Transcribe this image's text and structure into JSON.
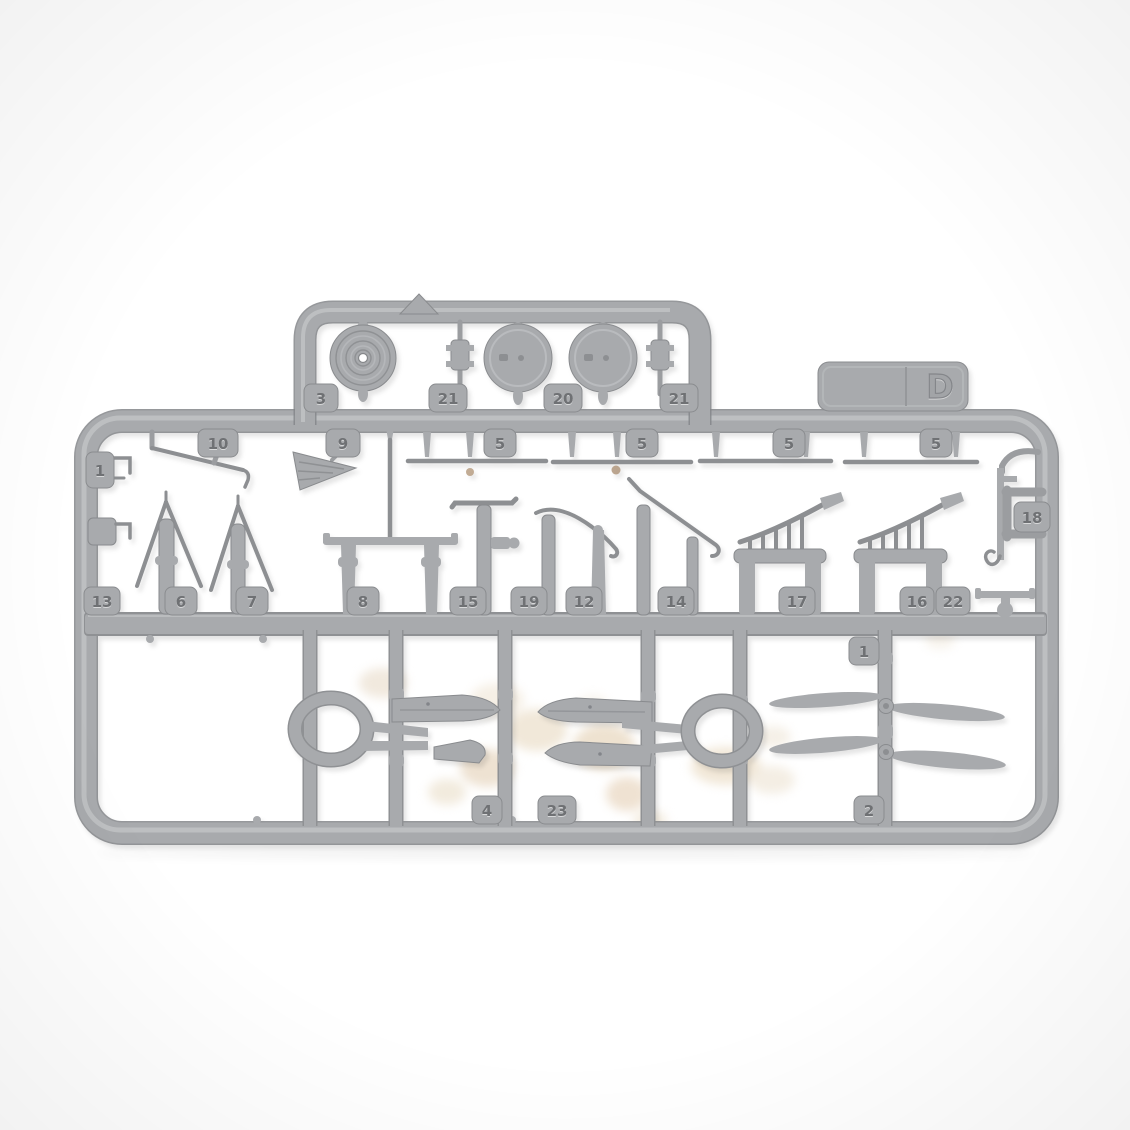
{
  "colors": {
    "plastic": "#a8aaad",
    "plastic_hi": "#c2c4c6",
    "plastic_lo": "#8f9194",
    "plastic_edge": "#84868a",
    "tab_text": "#6f7174",
    "bg": "#ffffff",
    "blob_light": "#f3ece1",
    "blob_tan": "#e9dcc9",
    "dust_dot": "#b2987e"
  },
  "sprue": {
    "gate_letter": "D",
    "tabs": {
      "top": [
        "3",
        "21",
        "20",
        "21"
      ],
      "upper": [
        "1",
        "10",
        "9",
        "5",
        "5",
        "5",
        "5",
        "18"
      ],
      "middle": [
        "13",
        "6",
        "7",
        "8",
        "15",
        "19",
        "12",
        "14",
        "17",
        "16",
        "22"
      ],
      "lower": [
        "1",
        "4",
        "23",
        "2"
      ]
    }
  }
}
